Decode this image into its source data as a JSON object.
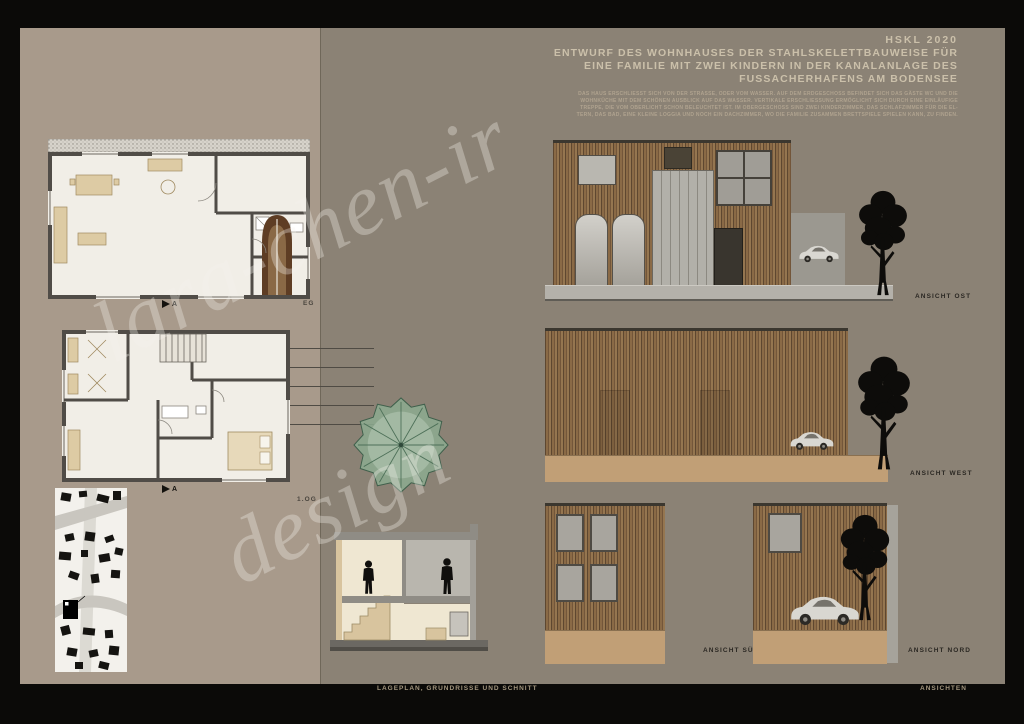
{
  "header": {
    "project_code": "HSKL 2020",
    "title_lines": [
      "ENTWURF DES WOHNHAUSES DER STAHLSKELETTBAUWEISE FÜR",
      "EINE FAMILIE MIT ZWEI KINDERN IN DER KANALANLAGE DES",
      "FUSSACHERHAFENS AM BODENSEE"
    ],
    "description_lines": [
      "DAS HAUS ERSCHLIESST SICH VON DER STRASSE, ODER VOM WASSER. AUF DEM ERDGESCHOSS BEFINDET SICH DAS GÄSTE WC UND DIE",
      "WOHNKÜCHE MIT DEM SCHÖNEN AUSBLICK AUF DAS WASSER. VERTIKALE ERSCHLIESSUNG ERMÖGLICHT SICH DURCH EINE EINLÄUFIGE",
      "TREPPE, DIE VOM OBERLICHT SCHON BELEUCHTET IST. IM OBERGESCHOSS SIND ZWEI KINDERZIMMER, DAS SCHLAFZIMMER FÜR DIE EL-",
      "TERN, DAS BAD, EINE KLEINE LOGGIA UND NOCH EIN DACHZIMMER, WO DIE FAMILIE ZUSAMMEN BRETTSPIELE SPIELEN KANN, ZU FINDEN."
    ]
  },
  "plans": {
    "eg_label": "EG",
    "og_label": "1.OG",
    "section_marker": "A"
  },
  "elevations": {
    "ost_label": "ANSICHT OST",
    "west_label": "ANSICHT WEST",
    "sued_label": "ANSICHT SÜD",
    "nord_label": "ANSICHT NORD"
  },
  "footer": {
    "left_caption": "LAGEPLAN, GRUNDRISSE UND SCHNITT",
    "right_caption": "ANSICHTEN"
  },
  "watermark": {
    "line1": "lara-chen-ir",
    "line2": "design"
  },
  "colors": {
    "frame": "#0b0a08",
    "panel_left": "#a89a8b",
    "panel_right": "#8b8275",
    "title_text": "#cbc0aa",
    "wood_facade": "#7d5f3f",
    "sand_band": "#c19f76",
    "concrete": "#b4b1aa"
  }
}
